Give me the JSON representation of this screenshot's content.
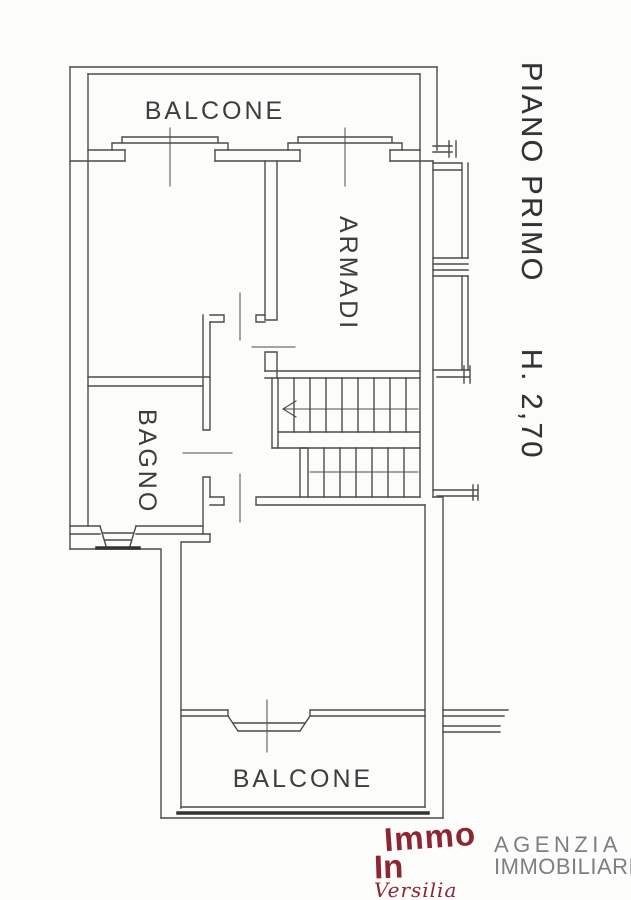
{
  "plan": {
    "floor_title": "PIANO PRIMO",
    "floor_height": "H. 2,70",
    "rooms": [
      {
        "id": "balcone-top",
        "label": "BALCONE"
      },
      {
        "id": "armadi",
        "label": "ARMADI"
      },
      {
        "id": "bagno",
        "label": "BAGNO"
      },
      {
        "id": "balcone-bottom",
        "label": "BALCONE"
      }
    ]
  },
  "footer": {
    "logo_line1": "Immo",
    "logo_line2": "In",
    "logo_script": "Versilia",
    "agency_line1": "AGENZIA",
    "agency_line2": "IMMOBILIARE"
  },
  "colors": {
    "paper": "#fcfcfa",
    "line": "#4b4b4b",
    "logo_red": "#8e2533",
    "agency_gray": "#7d7f82"
  }
}
